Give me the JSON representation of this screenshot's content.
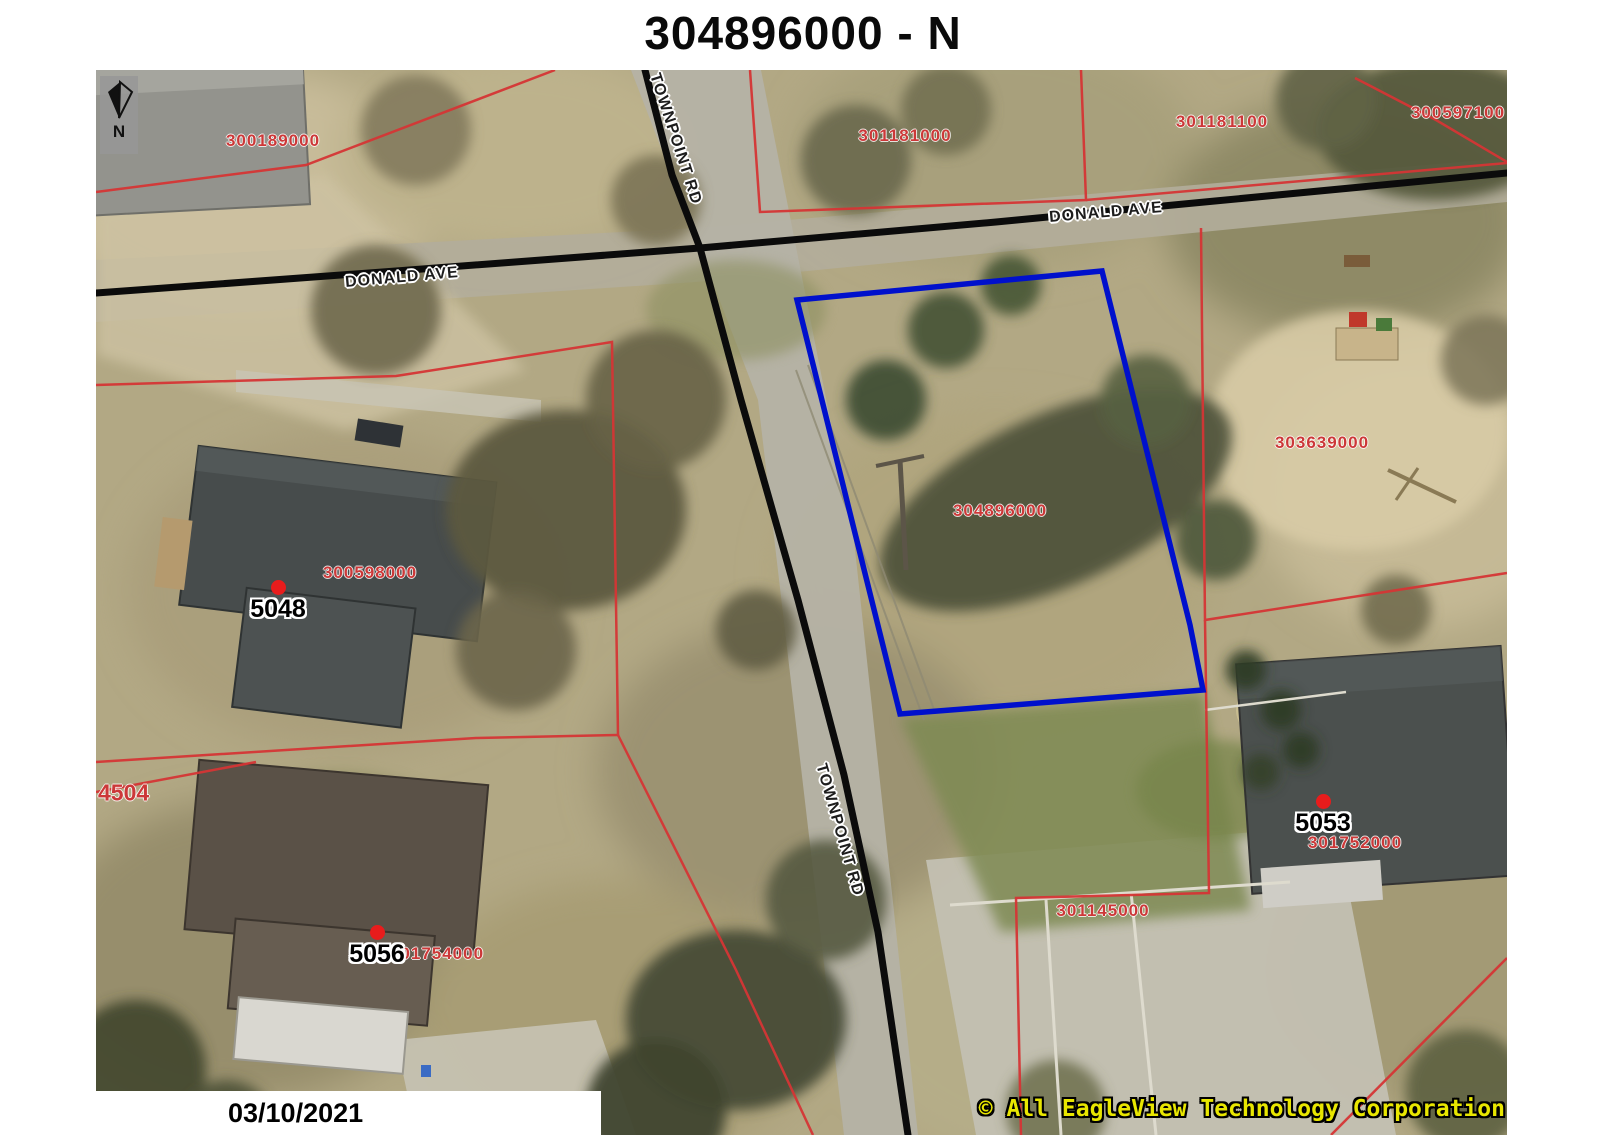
{
  "title": "304896000 - N",
  "compass": {
    "label": "N"
  },
  "streets": [
    {
      "name": "donald-ave-west",
      "label": "DONALD AVE"
    },
    {
      "name": "donald-ave-east",
      "label": "DONALD AVE"
    },
    {
      "name": "townpoint-rd-north",
      "label": "TOWNPOINT RD"
    },
    {
      "name": "townpoint-rd-south",
      "label": "TOWNPOINT RD"
    }
  ],
  "parcels": [
    {
      "id": "300189000"
    },
    {
      "id": "301181000"
    },
    {
      "id": "301181100"
    },
    {
      "id": "300597100"
    },
    {
      "id": "303639000"
    },
    {
      "id": "304896000"
    },
    {
      "id": "300598000"
    },
    {
      "id": "4504"
    },
    {
      "id": "301754000"
    },
    {
      "id": "301145000"
    },
    {
      "id": "301752000"
    }
  ],
  "addresses": [
    {
      "number": "5048"
    },
    {
      "number": "5056"
    },
    {
      "number": "5053"
    }
  ],
  "highlight": {
    "parcel_id": "304896000",
    "outline_color": "#0010cc"
  },
  "footer": {
    "date": "03/10/2021",
    "copyright": "© All EagleView Technology Corporation"
  },
  "colors": {
    "parcel_line": "#d53535",
    "road_line": "#0b0b0b",
    "parcel_label": "#cc3838",
    "address_dot": "#e81c1c",
    "copyright_text": "#e8e600"
  }
}
